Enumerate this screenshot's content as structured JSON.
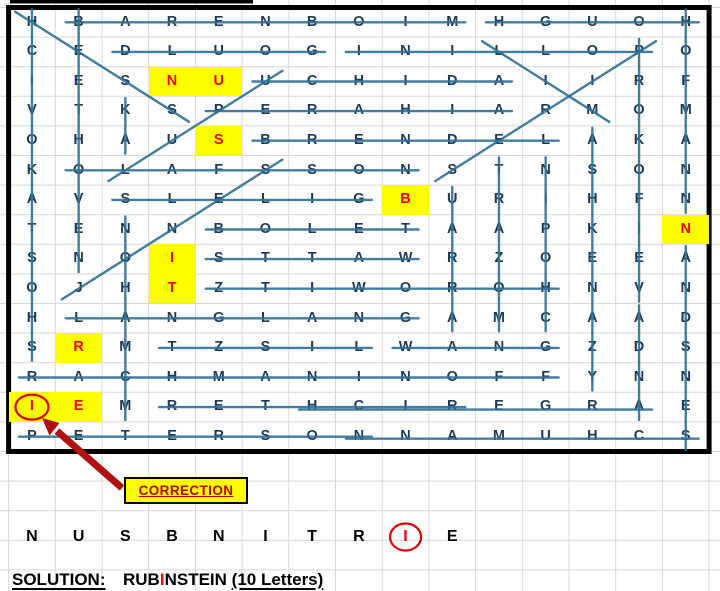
{
  "puzzle": {
    "theme": "pianists word search",
    "grid_rows": [
      "HBARENBOIMHGUOH",
      "CEDLUOGINILLOPO",
      "IESNUUCHIDAIIRF",
      "VTKSPERAHIARMOM",
      "OHAUSBRENDELAKA",
      "KOLAFSSONSTNSON",
      "AVSLELIGBURIHFN",
      "TENNBOLETAAPKIN",
      "SNOISTTAWRZOEEA",
      "OJHTZTIWOROHNVN",
      "HLANGLANGAMCAAD",
      "SRMTZSILWANGZDS",
      "RACHMANINOFFYNN",
      "IEMRETHCIREGRAE",
      "PETERSONNAMUHCS"
    ],
    "highlighted_cells": [
      {
        "row": 3,
        "col": 4,
        "letter": "N"
      },
      {
        "row": 3,
        "col": 5,
        "letter": "U"
      },
      {
        "row": 5,
        "col": 5,
        "letter": "S"
      },
      {
        "row": 7,
        "col": 9,
        "letter": "B"
      },
      {
        "row": 8,
        "col": 15,
        "letter": "N"
      },
      {
        "row": 9,
        "col": 4,
        "letter": "I"
      },
      {
        "row": 10,
        "col": 4,
        "letter": "T"
      },
      {
        "row": 12,
        "col": 2,
        "letter": "R"
      },
      {
        "row": 14,
        "col": 1,
        "letter": "I"
      },
      {
        "row": 14,
        "col": 2,
        "letter": "E"
      }
    ],
    "circled_cell": {
      "row": 14,
      "col": 1,
      "letter": "I"
    },
    "strike_words": [
      {
        "word": "BARENBOIM",
        "from": [
          1,
          2
        ],
        "to": [
          1,
          10
        ]
      },
      {
        "word": "HOUGH",
        "from": [
          1,
          11
        ],
        "to": [
          1,
          15
        ]
      },
      {
        "word": "GOULD",
        "from": [
          2,
          3
        ],
        "to": [
          2,
          7
        ]
      },
      {
        "word": "POLLINI",
        "from": [
          2,
          8
        ],
        "to": [
          2,
          14
        ]
      },
      {
        "word": "UCHIDA",
        "from": [
          3,
          6
        ],
        "to": [
          3,
          11
        ]
      },
      {
        "word": "PERAHIA",
        "from": [
          4,
          5
        ],
        "to": [
          4,
          11
        ]
      },
      {
        "word": "BRENDEL",
        "from": [
          5,
          6
        ],
        "to": [
          5,
          12
        ]
      },
      {
        "word": "OLAFSSON",
        "from": [
          6,
          2
        ],
        "to": [
          6,
          9
        ]
      },
      {
        "word": "GILELS",
        "from": [
          7,
          3
        ],
        "to": [
          7,
          8
        ]
      },
      {
        "word": "BOLET",
        "from": [
          8,
          5
        ],
        "to": [
          8,
          9
        ]
      },
      {
        "word": "WATTS",
        "from": [
          9,
          5
        ],
        "to": [
          9,
          9
        ]
      },
      {
        "word": "HOROWITZ",
        "from": [
          10,
          5
        ],
        "to": [
          10,
          12
        ]
      },
      {
        "word": "LANGLANG",
        "from": [
          11,
          2
        ],
        "to": [
          11,
          9
        ]
      },
      {
        "word": "LISZT",
        "from": [
          12,
          4
        ],
        "to": [
          12,
          8
        ]
      },
      {
        "word": "WANG",
        "from": [
          12,
          9
        ],
        "to": [
          12,
          12
        ]
      },
      {
        "word": "RACHMANINOFF",
        "from": [
          13,
          1
        ],
        "to": [
          13,
          12
        ]
      },
      {
        "word": "RICHTER",
        "from": [
          14,
          4
        ],
        "to": [
          14,
          10
        ]
      },
      {
        "word": "ARGERICH",
        "from": [
          14,
          7
        ],
        "to": [
          14,
          14
        ]
      },
      {
        "word": "PETERSON",
        "from": [
          15,
          1
        ],
        "to": [
          15,
          8
        ]
      },
      {
        "word": "SCHUMANN",
        "from": [
          15,
          8
        ],
        "to": [
          15,
          15
        ]
      },
      {
        "word": "SHOSTAKOVICH",
        "from": [
          1,
          1
        ],
        "to": [
          12,
          1
        ]
      },
      {
        "word": "BEETHOVEN",
        "from": [
          1,
          2
        ],
        "to": [
          9,
          2
        ]
      },
      {
        "word": "KA",
        "from": [
          4,
          3
        ],
        "to": [
          5,
          3
        ]
      },
      {
        "word": "MCMAHON",
        "from": [
          8,
          3
        ],
        "to": [
          14,
          3
        ]
      },
      {
        "word": "ARRAU",
        "from": [
          7,
          10
        ],
        "to": [
          11,
          10
        ]
      },
      {
        "word": "MOZART",
        "from": [
          6,
          11
        ],
        "to": [
          11,
          11
        ]
      },
      {
        "word": "CHOPIN",
        "from": [
          6,
          12
        ],
        "to": [
          11,
          12
        ]
      },
      {
        "word": "ASHKENAZY",
        "from": [
          5,
          13
        ],
        "to": [
          13,
          13
        ]
      },
      {
        "word": "PROKOFIEV",
        "from": [
          2,
          14
        ],
        "to": [
          10,
          14
        ]
      },
      {
        "word": "ANDA",
        "from": [
          11,
          14
        ],
        "to": [
          14,
          14
        ]
      },
      {
        "word": "HOFMANN",
        "from": [
          1,
          15
        ],
        "to": [
          7,
          15
        ]
      },
      {
        "word": "ANDSNES",
        "from": [
          9,
          15
        ],
        "to": [
          15,
          15
        ]
      },
      {
        "word": "HESS",
        "from": [
          1,
          1
        ],
        "to": [
          4,
          4
        ]
      },
      {
        "word": "LUPU",
        "from": [
          6,
          3
        ],
        "to": [
          3,
          6
        ]
      },
      {
        "word": "JONES",
        "from": [
          10,
          2
        ],
        "to": [
          6,
          6
        ]
      },
      {
        "word": "LIM",
        "from": [
          2,
          11
        ],
        "to": [
          4,
          13
        ]
      },
      {
        "word": "PIRES",
        "from": [
          2,
          14
        ],
        "to": [
          6,
          10
        ]
      }
    ]
  },
  "correction": {
    "label": "CORRECTION"
  },
  "solution_row": {
    "letters": [
      "N",
      "U",
      "S",
      "B",
      "N",
      "I",
      "T",
      "R",
      "I",
      "E"
    ],
    "red_index": 8,
    "circled_index": 8
  },
  "solution": {
    "label": "SOLUTION:",
    "answer_before": "RUB",
    "answer_red": "I",
    "answer_after": "NSTEIN",
    "count_note": "(10 Letters)"
  },
  "colors": {
    "letter": "#1f3a56",
    "strike": "#2e7095",
    "gridline": "#d8d8d8",
    "border": "#000000",
    "highlight": "#ffff00",
    "highlight_letter": "#ff0000",
    "red_circle": "#e00000",
    "arrow": "#b01212",
    "correction_text": "#c00000"
  }
}
